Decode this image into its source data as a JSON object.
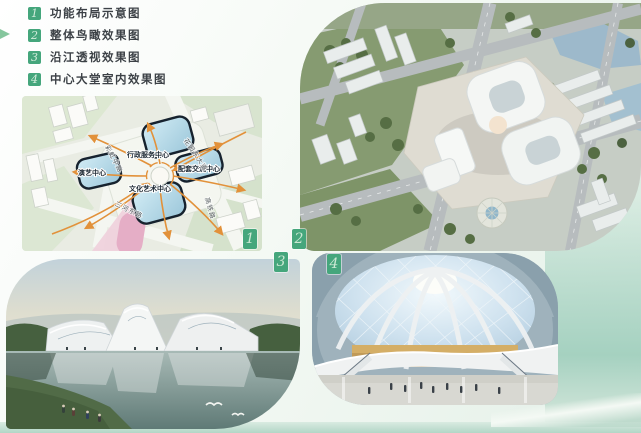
{
  "legend": {
    "items": [
      {
        "num": "1",
        "label": "功能布局示意图"
      },
      {
        "num": "2",
        "label": "整体鸟瞰效果图"
      },
      {
        "num": "3",
        "label": "沿江透视效果图"
      },
      {
        "num": "4",
        "label": "中心大堂室内效果图"
      }
    ]
  },
  "figures": {
    "plan": {
      "badge": "1",
      "building_labels": {
        "admin": "行政服务中心",
        "exchange": "配套交流中心",
        "performing": "演艺中心",
        "culture": "文化艺术中心"
      },
      "road_labels": {
        "garden_east_avenue": "花园东大道",
        "sanhe_east_road": "三河东路",
        "rainbow_middle_road": "彩虹中路",
        "east_side_road": "高铁路"
      }
    },
    "aerial": {
      "badge": "2"
    },
    "riverside": {
      "badge": "3"
    },
    "lobby": {
      "badge": "4"
    }
  },
  "colors": {
    "badge_green": "#45a67c",
    "badge_number_green": "#cbe8d3",
    "accent_teal_band": "#a5d1c0",
    "legend_arrow_green": "#85c69d",
    "plan_glass_blue": "#b6dce9",
    "plan_outline_dark": "#16222e",
    "plan_arrow_orange": "#e2913a",
    "plan_plaza_pink": "#eabed2"
  }
}
